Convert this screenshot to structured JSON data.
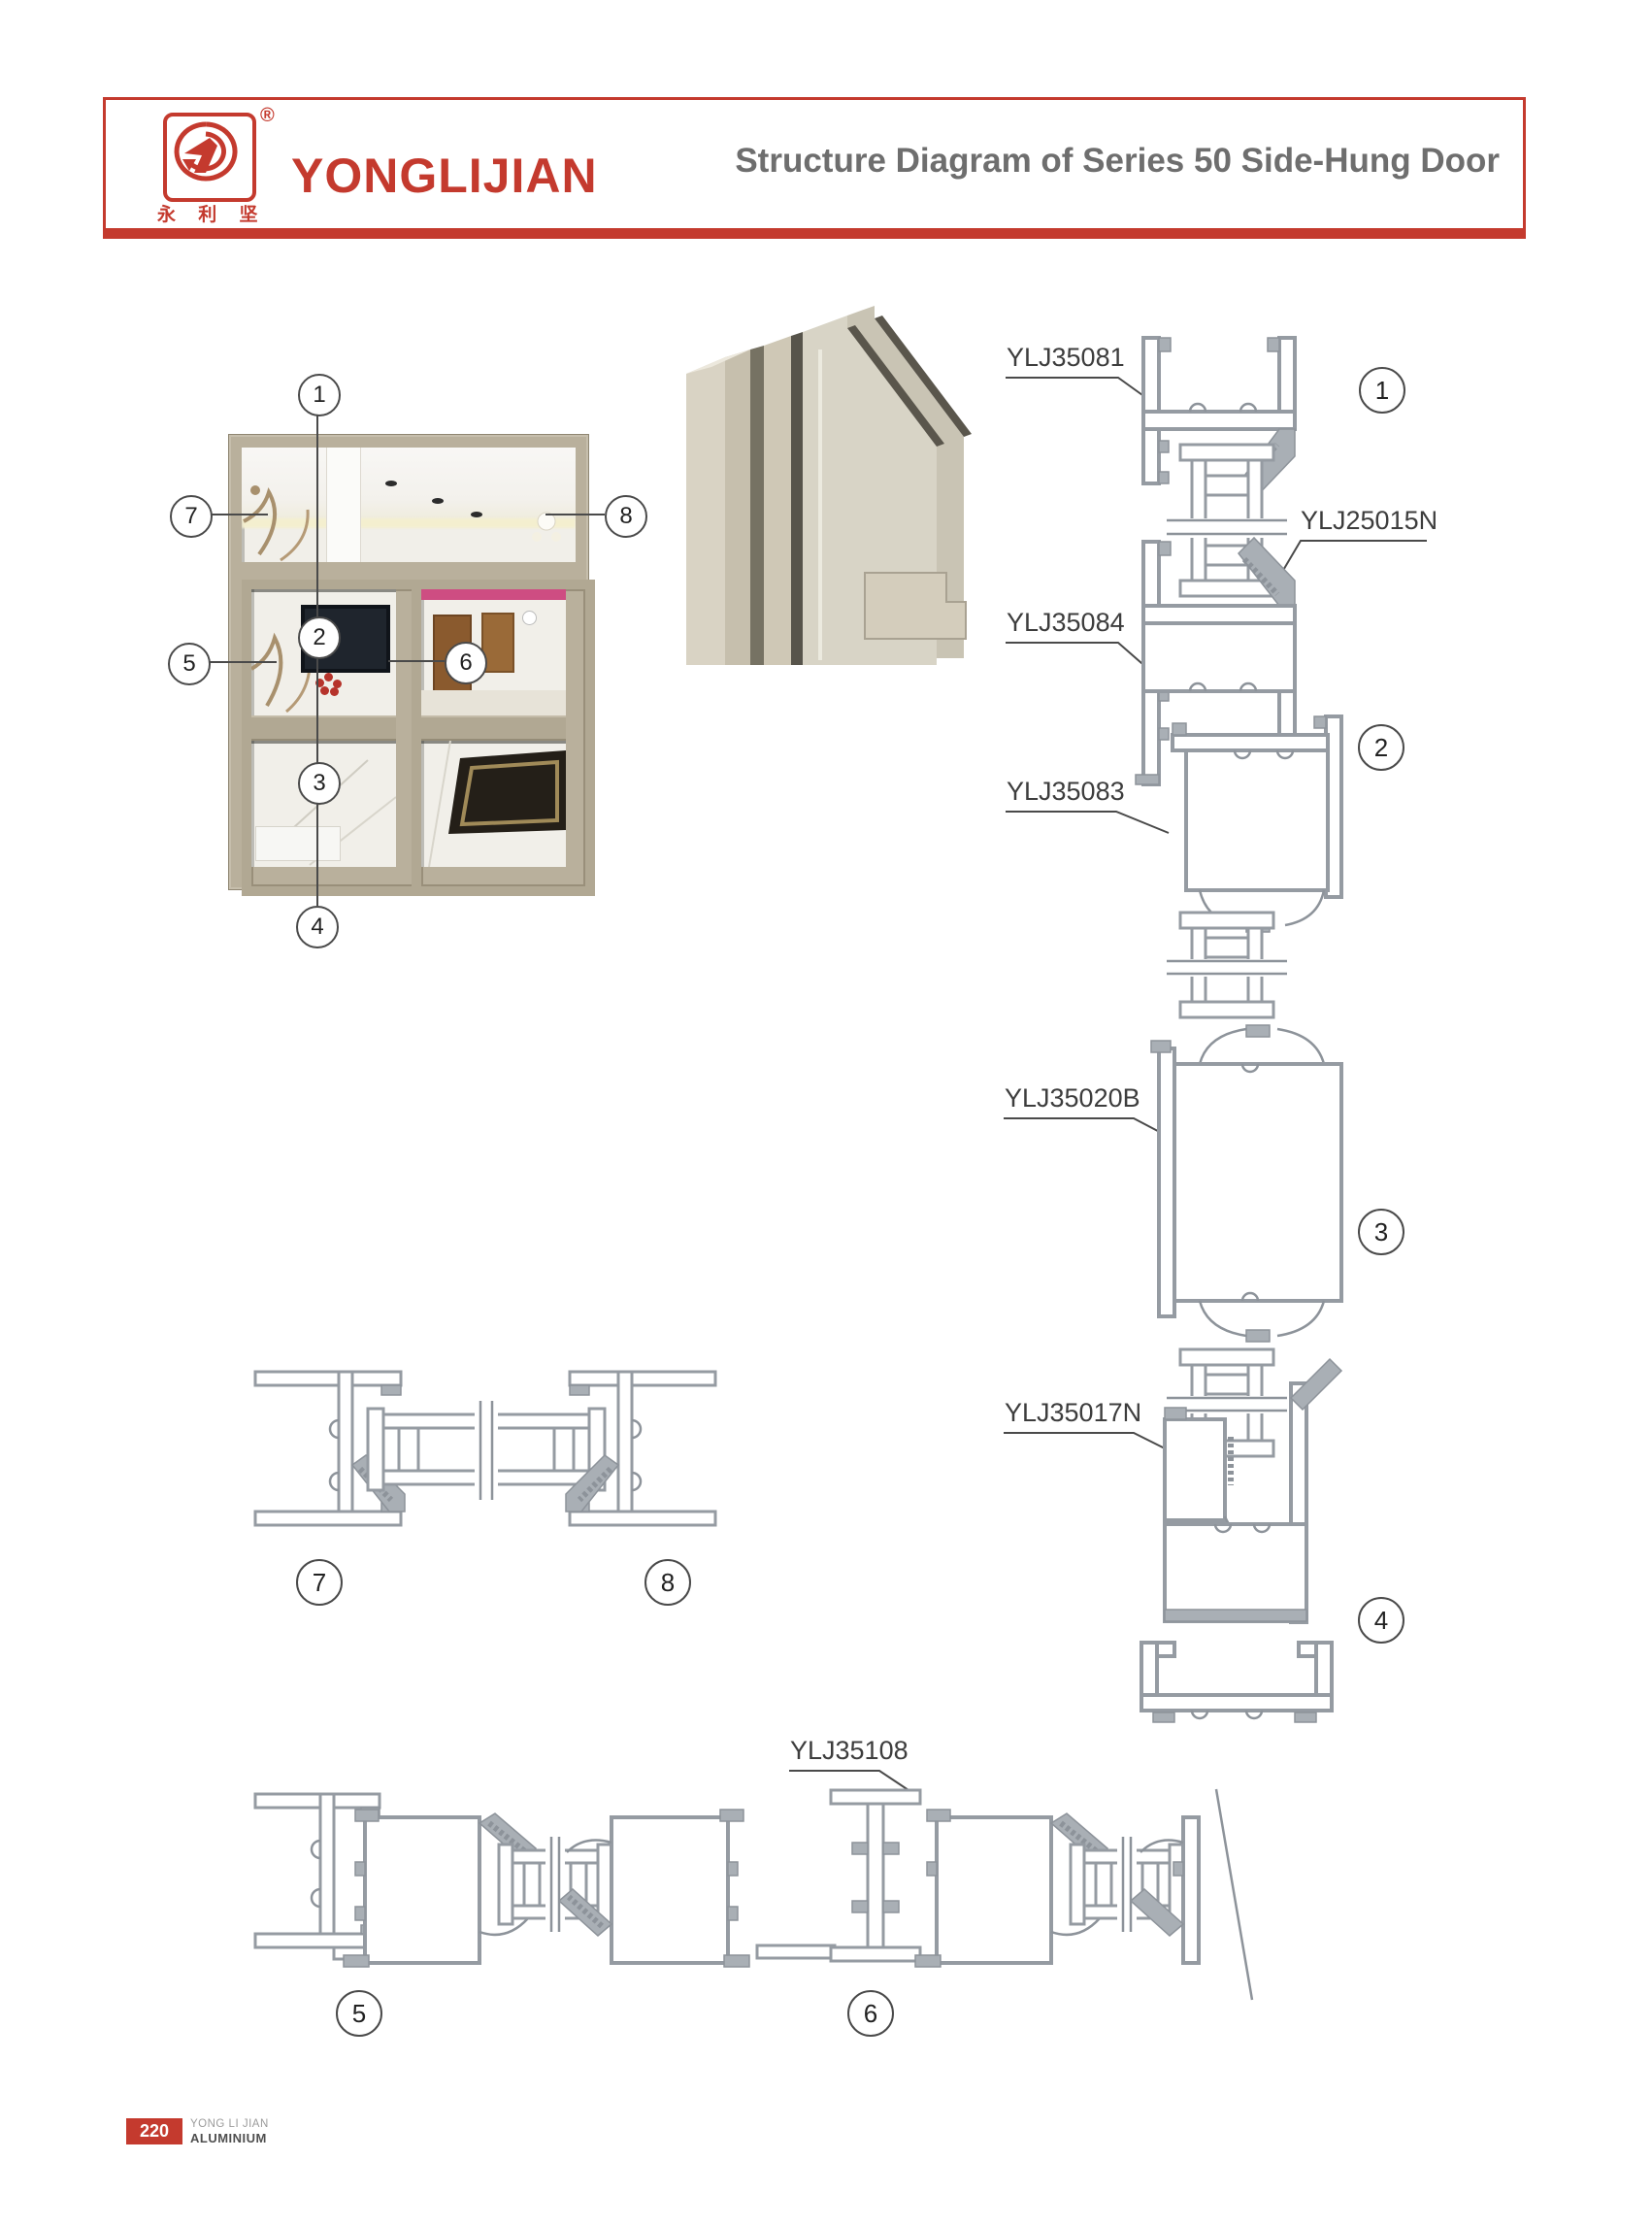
{
  "header": {
    "brand": "YONGLIJIAN",
    "brand_cn": "永 利 坚",
    "registered_mark": "®",
    "title": "Structure Diagram of Series 50 Side-Hung Door",
    "accent_color": "#c43a2e"
  },
  "callouts": {
    "n1": "1",
    "n2": "2",
    "n3": "3",
    "n4": "4",
    "n5": "5",
    "n6": "6",
    "n7": "7",
    "n8": "8"
  },
  "parts": {
    "head_frame": "YLJ35081",
    "glazing_bead": "YLJ25015N",
    "sash_top": "YLJ35084",
    "transom": "YLJ35083",
    "door_leaf": "YLJ35020B",
    "bottom_rail": "YLJ35017N",
    "mullion": "YLJ35108"
  },
  "footer": {
    "page_number": "220",
    "company_line1": "YONG LI JIAN",
    "company_line2": "ALUMINIUM"
  }
}
